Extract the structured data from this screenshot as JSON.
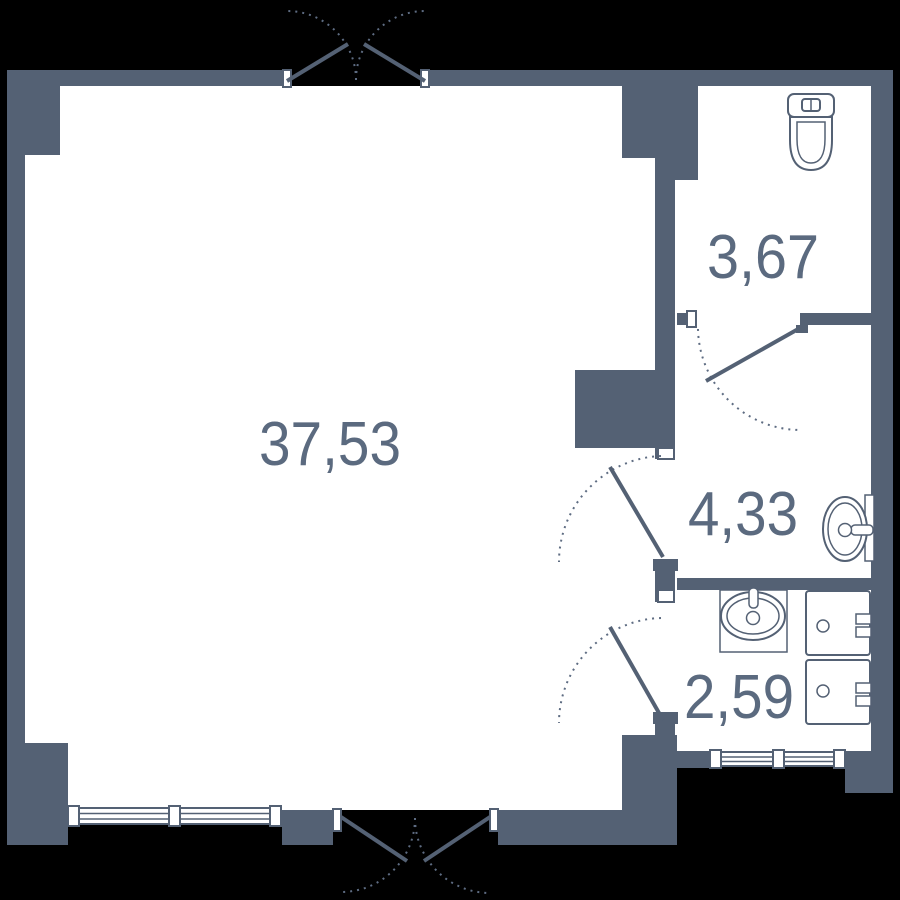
{
  "plan": {
    "type": "apartment-floor-plan",
    "rooms": [
      {
        "id": "room-main",
        "area_label": "37,53"
      },
      {
        "id": "room-top-right",
        "area_label": "3,67"
      },
      {
        "id": "room-mid-right",
        "area_label": "4,33"
      },
      {
        "id": "room-bottom-right",
        "area_label": "2,59"
      }
    ],
    "fixtures": [
      "toilet-icon",
      "wall-sink-icon",
      "vanity-sink-icon",
      "washing-machine-icon",
      "washing-machine-icon"
    ],
    "features": [
      "double-entry-door-top",
      "double-door-bottom",
      "window-bottom-left",
      "window-bottom-right",
      "interior-doors"
    ],
    "colors": {
      "background": "#000000",
      "wall": "#546174",
      "room_fill": "#ffffff",
      "label_text": "#5b6a7f",
      "swing_arc": "#5e6c82"
    }
  }
}
